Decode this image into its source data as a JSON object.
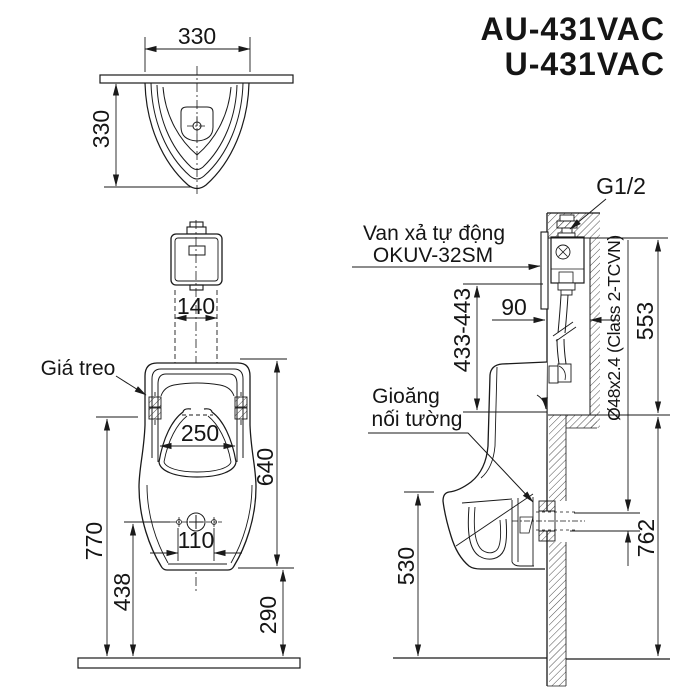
{
  "title": {
    "model_1": "AU-431VAC",
    "model_2": "U-431VAC"
  },
  "top_view": {
    "width": "330",
    "depth": "330"
  },
  "front_view": {
    "valve_width": "140",
    "bowl_width": "250",
    "total_height": "640",
    "hole_spacing": "110",
    "rim_height": "770",
    "hole_height": "438",
    "bottom_clearance": "290",
    "bracket_label": "Giá treo"
  },
  "side_view": {
    "valve_label_1": "Van xả tự động",
    "valve_label_2": "OKUV-32SM",
    "inlet_thread": "G1/2",
    "valve_drop": "433-443",
    "niche_depth": "90",
    "niche_height": "553",
    "pipe_spec": "Ø48x2.4 (Class 2-TCVN)",
    "gasket_label_1": "Gioăng",
    "gasket_label_2": "nối tường",
    "lip_height": "530",
    "outlet_height": "762"
  },
  "colors": {
    "line": "#1a1a1a",
    "background": "#ffffff"
  }
}
